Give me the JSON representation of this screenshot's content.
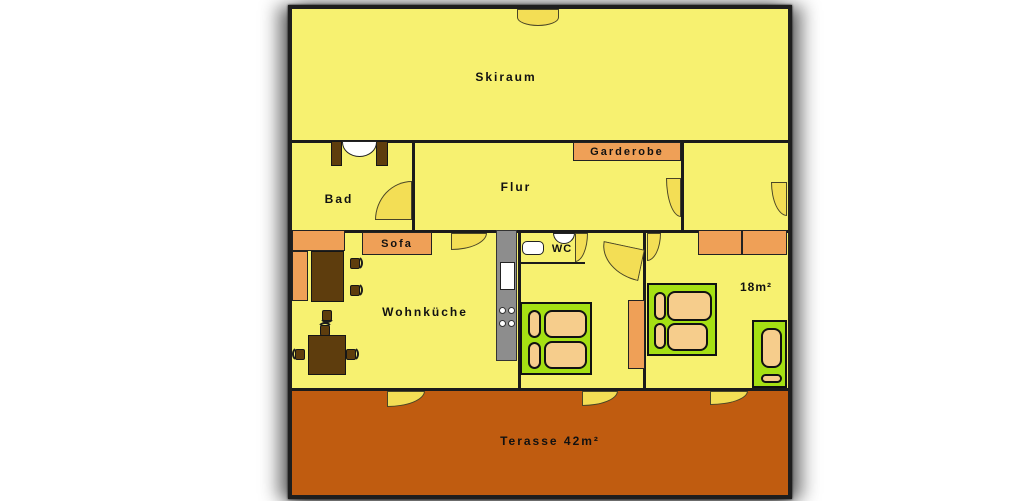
{
  "plan": {
    "labels": {
      "skiraum": "Skiraum",
      "bad": "Bad",
      "flur": "Flur",
      "garderobe": "Garderobe",
      "sofa": "Sofa",
      "wc": "WC",
      "wohnkueche": "Wohnküche",
      "bedroom_area": "18m²",
      "terrace": "Terasse 42m²"
    },
    "colors": {
      "room_fill": "#f7f170",
      "door_swing": "#f3de55",
      "furniture_orange": "#efa057",
      "terrace_rust": "#c05c10",
      "bed_green": "#a5e013",
      "cushion_tan": "#f6cd8c",
      "wood_brown": "#5e3d0d",
      "counter_gray": "#8d8d8d",
      "wall": "#1b1b1b",
      "fixture_white": "#ffffff",
      "text": "#111111"
    }
  }
}
